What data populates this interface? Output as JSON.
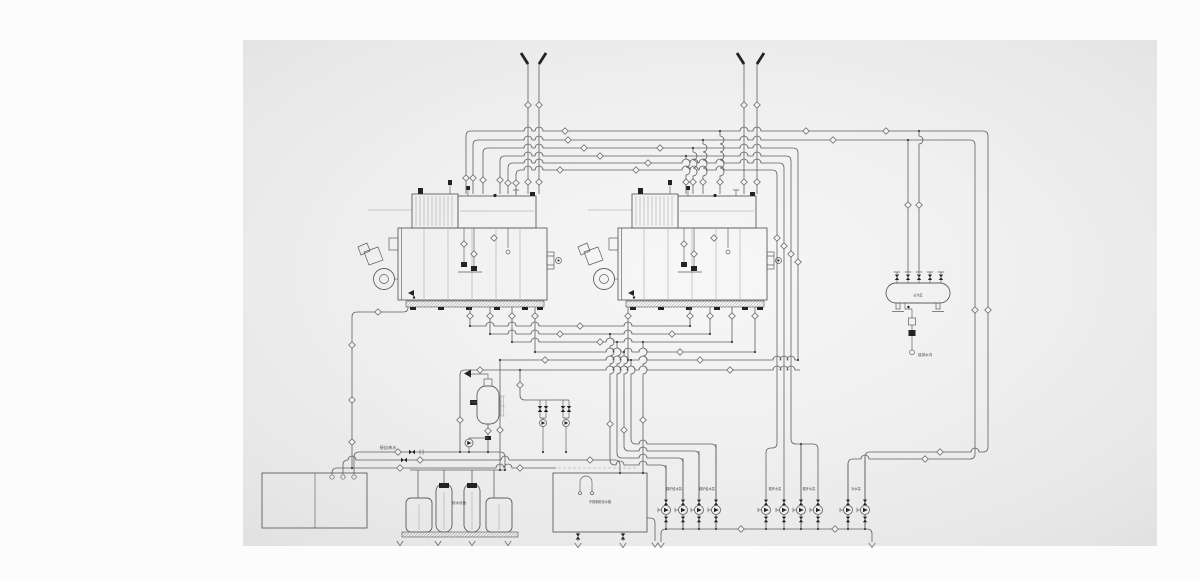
{
  "diagram": {
    "type": "boiler-plant-piping-schematic",
    "colors": {
      "line": "#5f5f5f",
      "light_line": "#9b9b9b",
      "dark": "#232323",
      "panel_edge": "#e4e4e5",
      "panel_center": "#f6f6f6",
      "page": "#fcfcfc"
    },
    "labels": {
      "steam_header": "分汽缸",
      "header_drain": "接排水沟",
      "tap_water": "接自来水",
      "softener": "软水设备",
      "water_tank": "不锈钢软化水箱",
      "pump_group_1": "锅炉给水泵",
      "pump_group_2": "锅炉给水泵",
      "pump_group_3": "循环水泵",
      "pump_group_4": "循环水泵",
      "pump_group_5": "补水泵"
    },
    "equipment_icons": [
      "steam-boiler-icon",
      "burner-icon",
      "vent-stack-icon",
      "diamond-valve-icon",
      "steam-header-icon",
      "water-softener-icon",
      "softened-water-tank-icon",
      "deaerator-icon",
      "feed-pump-icon",
      "check-valve-icon",
      "drain-arrow-icon"
    ]
  }
}
